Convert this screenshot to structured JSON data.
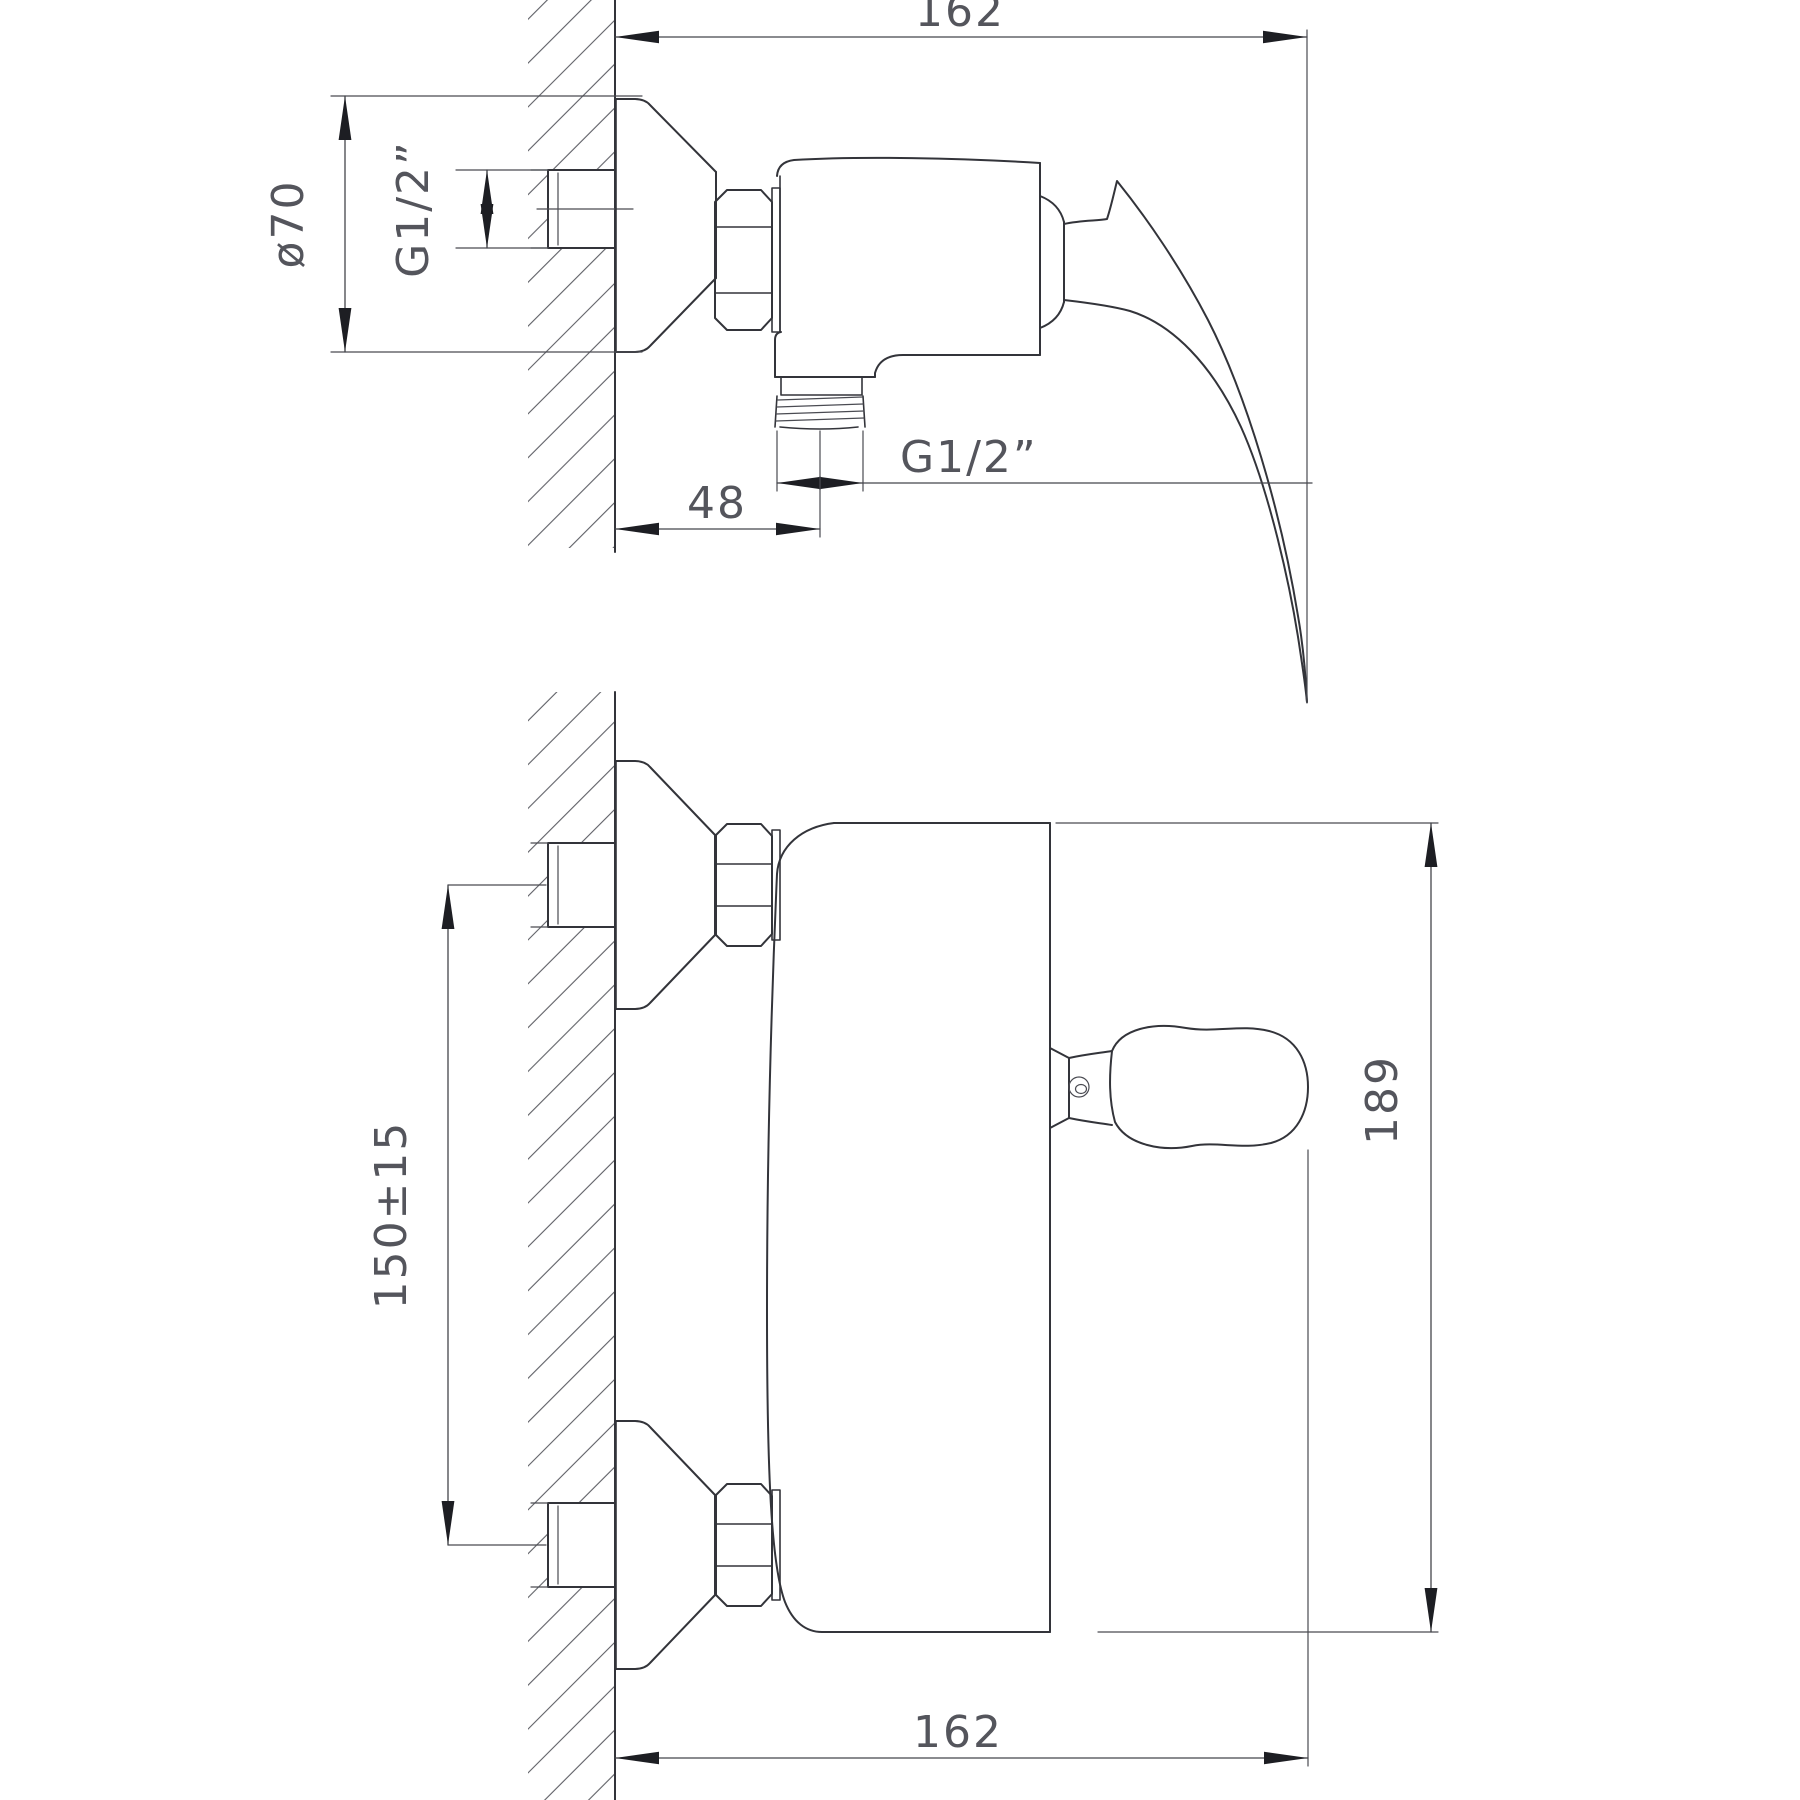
{
  "drawing": {
    "type": "technical-orthographic-diagram",
    "background": "#ffffff",
    "line_color": "#33343a",
    "dimension_color": "#54555c",
    "hatch_color": "#5e5f66",
    "views": {
      "side_view": {
        "position": "top"
      },
      "front_view": {
        "position": "bottom"
      }
    },
    "dims": {
      "side_width": "162",
      "flange_diameter": "ø70",
      "wall_thread": "G1/2”",
      "outlet_offset": "48",
      "outlet_thread": "G1/2”",
      "inlet_spacing": "150±15",
      "front_height": "189",
      "front_width": "162"
    }
  }
}
